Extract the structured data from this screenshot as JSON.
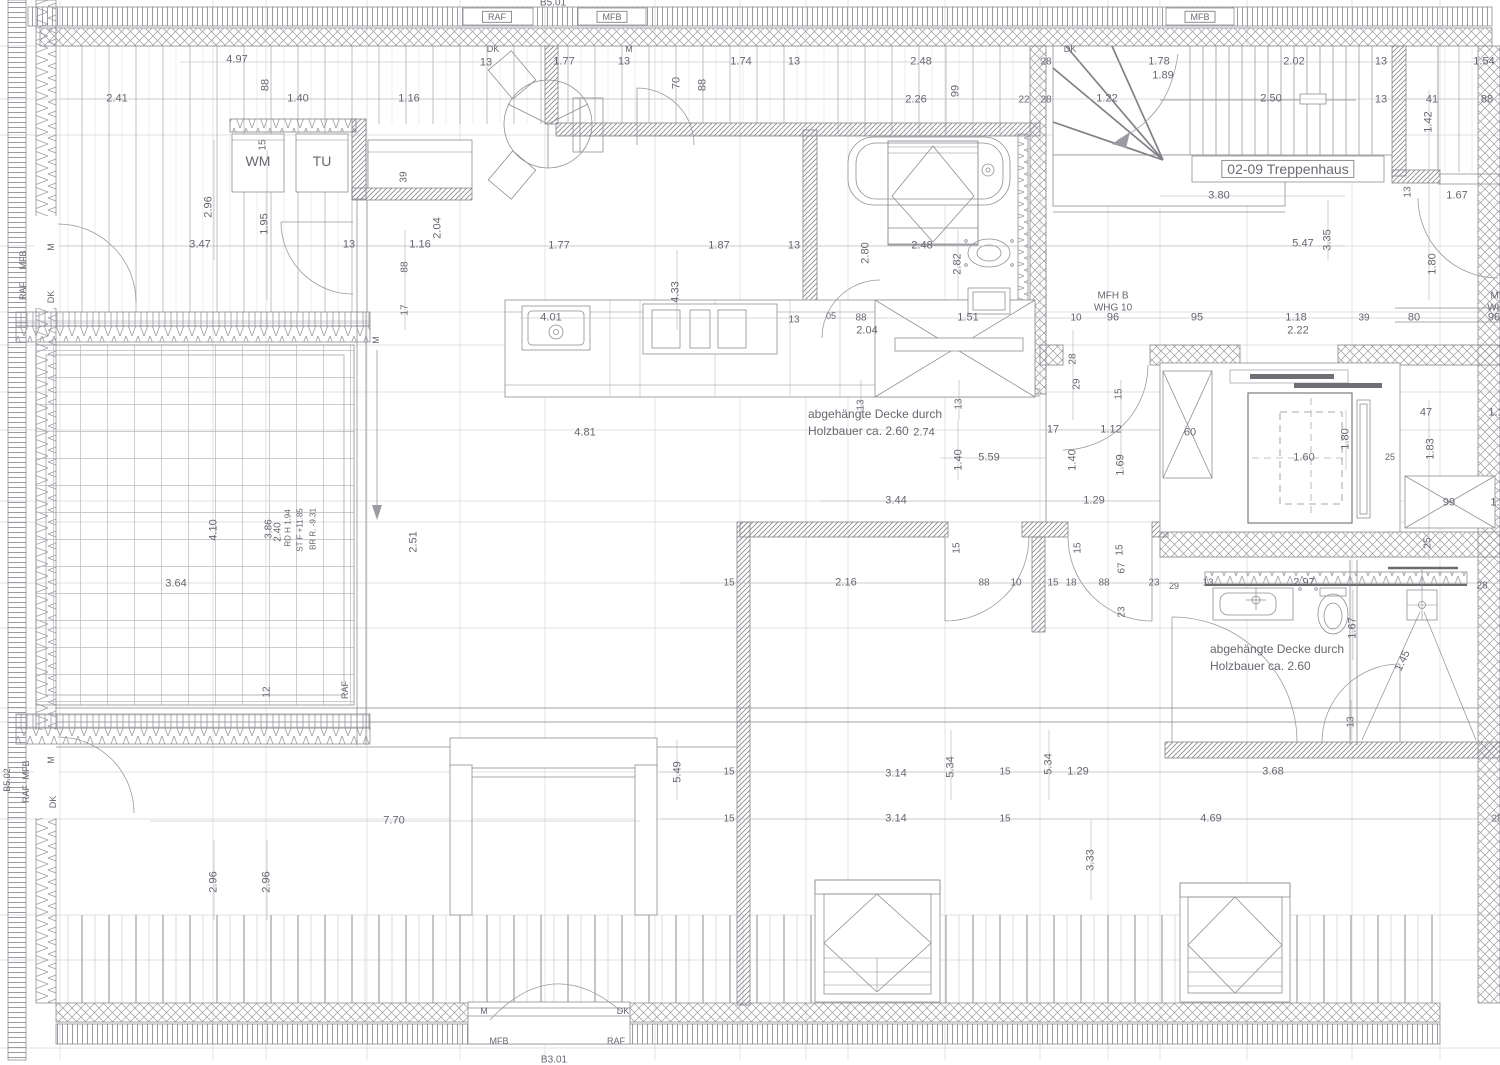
{
  "drawing": {
    "kind": "floor-plan",
    "language": "de",
    "stairwell_label": "02-09 Treppenhaus",
    "apartments": [
      "MFH B WHG 10",
      "MFH B WHG 11"
    ],
    "notes": [
      "abgehängte Decke durch Holzbauer ca. 2.60"
    ],
    "component_tags": [
      "B5.01",
      "B3.01",
      "B5.02"
    ],
    "layer_tags": [
      "RAF",
      "MFB",
      "DK",
      "M"
    ]
  },
  "colors": {
    "line": "#8e8e94",
    "light_line": "#d6d6da",
    "dim_line": "#b4b4ba",
    "text": "#67676f",
    "dark": "#6b6b70",
    "bg": "#ffffff"
  },
  "labels": [
    {
      "t": "RAF",
      "x": 497,
      "y": 17,
      "b": 1,
      "s": 9,
      "n": "layer-tag"
    },
    {
      "t": "MFB",
      "x": 612,
      "y": 17,
      "b": 1,
      "s": 9,
      "n": "layer-tag"
    },
    {
      "t": "MFB",
      "x": 1200,
      "y": 17,
      "b": 1,
      "s": 9,
      "n": "layer-tag"
    },
    {
      "t": "B5.01",
      "x": 553,
      "y": 3,
      "s": 10,
      "n": "component-tag"
    },
    {
      "t": "4.97",
      "x": 237,
      "y": 60
    },
    {
      "t": "DK",
      "x": 493,
      "y": 49,
      "s": 9,
      "n": "layer-tag"
    },
    {
      "t": "13",
      "x": 486,
      "y": 63
    },
    {
      "t": "1.77",
      "x": 564,
      "y": 62
    },
    {
      "t": "13",
      "x": 624,
      "y": 62
    },
    {
      "t": "M",
      "x": 629,
      "y": 49,
      "s": 9,
      "n": "layer-tag"
    },
    {
      "t": "1.74",
      "x": 741,
      "y": 62
    },
    {
      "t": "13",
      "x": 794,
      "y": 62
    },
    {
      "t": "2.48",
      "x": 921,
      "y": 62
    },
    {
      "t": "DK",
      "x": 1070,
      "y": 49,
      "s": 9,
      "n": "layer-tag"
    },
    {
      "t": "28",
      "x": 1046,
      "y": 62,
      "s": 10
    },
    {
      "t": "1.78",
      "x": 1159,
      "y": 62
    },
    {
      "t": "1.89",
      "x": 1163,
      "y": 76
    },
    {
      "t": "2.02",
      "x": 1294,
      "y": 62
    },
    {
      "t": "13",
      "x": 1381,
      "y": 62
    },
    {
      "t": "1.54",
      "x": 1484,
      "y": 62
    },
    {
      "t": "70",
      "x": 677,
      "y": 83,
      "v": 1
    },
    {
      "t": "88",
      "x": 703,
      "y": 85,
      "v": 1
    },
    {
      "t": "88",
      "x": 266,
      "y": 85,
      "v": 1
    },
    {
      "t": "99",
      "x": 956,
      "y": 91,
      "v": 1
    },
    {
      "t": "2.41",
      "x": 117,
      "y": 99
    },
    {
      "t": "1.40",
      "x": 298,
      "y": 99
    },
    {
      "t": "1.16",
      "x": 409,
      "y": 99
    },
    {
      "t": "2.26",
      "x": 916,
      "y": 100
    },
    {
      "t": "22",
      "x": 1024,
      "y": 100,
      "s": 10
    },
    {
      "t": "28",
      "x": 1046,
      "y": 100,
      "s": 10
    },
    {
      "t": "1.22",
      "x": 1107,
      "y": 99
    },
    {
      "t": "2.50",
      "x": 1271,
      "y": 99
    },
    {
      "t": "13",
      "x": 1381,
      "y": 100
    },
    {
      "t": "41",
      "x": 1432,
      "y": 100
    },
    {
      "t": "88",
      "x": 1487,
      "y": 100
    },
    {
      "t": "1.42",
      "x": 1429,
      "y": 122,
      "v": 1
    },
    {
      "t": "WM",
      "x": 258,
      "y": 161,
      "s": 14,
      "n": "washing-machine-label"
    },
    {
      "t": "TU",
      "x": 322,
      "y": 161,
      "s": 14,
      "n": "dryer-label"
    },
    {
      "t": "15",
      "x": 263,
      "y": 145,
      "v": 1,
      "s": 10
    },
    {
      "t": "39",
      "x": 404,
      "y": 177,
      "v": 1,
      "s": 10
    },
    {
      "t": "2.96",
      "x": 209,
      "y": 207,
      "v": 1
    },
    {
      "t": "1.95",
      "x": 265,
      "y": 224,
      "v": 1
    },
    {
      "t": "2.04",
      "x": 438,
      "y": 228,
      "v": 1
    },
    {
      "t": "3.80",
      "x": 1219,
      "y": 196
    },
    {
      "t": "02-09 Treppenhaus",
      "x": 1288,
      "y": 169,
      "s": 14,
      "b": 1,
      "n": "stairwell-label"
    },
    {
      "t": "13",
      "x": 1408,
      "y": 192,
      "v": 1,
      "s": 10
    },
    {
      "t": "1.67",
      "x": 1457,
      "y": 196
    },
    {
      "t": "3.47",
      "x": 200,
      "y": 245
    },
    {
      "t": "13",
      "x": 349,
      "y": 245
    },
    {
      "t": "1.16",
      "x": 420,
      "y": 245
    },
    {
      "t": "1.77",
      "x": 559,
      "y": 246
    },
    {
      "t": "1.87",
      "x": 719,
      "y": 246
    },
    {
      "t": "13",
      "x": 794,
      "y": 246
    },
    {
      "t": "2.48",
      "x": 922,
      "y": 246
    },
    {
      "t": "5.47",
      "x": 1303,
      "y": 244
    },
    {
      "t": "3.35",
      "x": 1328,
      "y": 240,
      "v": 1
    },
    {
      "t": "2.80",
      "x": 866,
      "y": 253,
      "v": 1
    },
    {
      "t": "2.82",
      "x": 958,
      "y": 264,
      "v": 1
    },
    {
      "t": "1.80",
      "x": 1433,
      "y": 264,
      "v": 1
    },
    {
      "t": "88",
      "x": 405,
      "y": 267,
      "v": 1,
      "s": 10
    },
    {
      "t": "17",
      "x": 405,
      "y": 310,
      "v": 1,
      "s": 10
    },
    {
      "t": "4.01",
      "x": 551,
      "y": 318
    },
    {
      "t": "13",
      "x": 794,
      "y": 320,
      "s": 10
    },
    {
      "t": "05",
      "x": 831,
      "y": 316,
      "s": 9
    },
    {
      "t": "88",
      "x": 861,
      "y": 318,
      "s": 10
    },
    {
      "t": "2.04",
      "x": 867,
      "y": 331
    },
    {
      "t": "1.51",
      "x": 968,
      "y": 318
    },
    {
      "t": "10",
      "x": 1076,
      "y": 318,
      "s": 10
    },
    {
      "t": "96",
      "x": 1113,
      "y": 318
    },
    {
      "t": "95",
      "x": 1197,
      "y": 318
    },
    {
      "t": "1.18",
      "x": 1296,
      "y": 318
    },
    {
      "t": "2.22",
      "x": 1298,
      "y": 331
    },
    {
      "t": "39",
      "x": 1364,
      "y": 318,
      "s": 10
    },
    {
      "t": "80",
      "x": 1414,
      "y": 318
    },
    {
      "t": "96",
      "x": 1494,
      "y": 318
    },
    {
      "t": "MFH B",
      "x": 1113,
      "y": 296,
      "s": 10,
      "n": "apartment-label"
    },
    {
      "t": "WHG 10",
      "x": 1113,
      "y": 308,
      "s": 10,
      "n": "apartment-label"
    },
    {
      "t": "MFH B",
      "x": 1506,
      "y": 296,
      "s": 10,
      "n": "apartment-label"
    },
    {
      "t": "WHG 11",
      "x": 1506,
      "y": 308,
      "s": 10,
      "n": "apartment-label"
    },
    {
      "t": "28",
      "x": 1073,
      "y": 359,
      "v": 1,
      "s": 10
    },
    {
      "t": "29",
      "x": 1077,
      "y": 384,
      "v": 1,
      "s": 10
    },
    {
      "t": "4.33",
      "x": 676,
      "y": 292,
      "v": 1
    },
    {
      "t": "4.81",
      "x": 585,
      "y": 433
    },
    {
      "t": "13",
      "x": 861,
      "y": 405,
      "v": 1,
      "s": 10
    },
    {
      "t": "13",
      "x": 959,
      "y": 404,
      "v": 1,
      "s": 10
    },
    {
      "t": "abgehängte Decke durch",
      "x": 808,
      "y": 415,
      "a": "l",
      "s": 12,
      "n": "ceiling-note"
    },
    {
      "t": "Holzbauer ca. 2.60",
      "x": 808,
      "y": 432,
      "a": "l",
      "s": 12,
      "n": "ceiling-note"
    },
    {
      "t": "2.74",
      "x": 924,
      "y": 433
    },
    {
      "t": "17",
      "x": 1053,
      "y": 430
    },
    {
      "t": "1.12",
      "x": 1111,
      "y": 430
    },
    {
      "t": "1.40",
      "x": 959,
      "y": 460,
      "v": 1
    },
    {
      "t": "5.59",
      "x": 989,
      "y": 458
    },
    {
      "t": "1.40",
      "x": 1073,
      "y": 460,
      "v": 1
    },
    {
      "t": "1.69",
      "x": 1121,
      "y": 465,
      "v": 1
    },
    {
      "t": "3.44",
      "x": 896,
      "y": 501
    },
    {
      "t": "1.29",
      "x": 1094,
      "y": 501
    },
    {
      "t": "2.51",
      "x": 414,
      "y": 542,
      "v": 1
    },
    {
      "t": "M",
      "x": 376,
      "y": 340,
      "v": 1,
      "s": 9,
      "n": "layer-tag"
    },
    {
      "t": "60",
      "x": 1190,
      "y": 433
    },
    {
      "t": "1.60",
      "x": 1304,
      "y": 458
    },
    {
      "t": "1.80",
      "x": 1346,
      "y": 439,
      "v": 1
    },
    {
      "t": "25",
      "x": 1390,
      "y": 457,
      "s": 9
    },
    {
      "t": "47",
      "x": 1426,
      "y": 413
    },
    {
      "t": "1.1",
      "x": 1496,
      "y": 413
    },
    {
      "t": "1.83",
      "x": 1431,
      "y": 449,
      "v": 1
    },
    {
      "t": "99",
      "x": 1449,
      "y": 503
    },
    {
      "t": "1.",
      "x": 1495,
      "y": 503
    },
    {
      "t": "25",
      "x": 1428,
      "y": 543,
      "v": 1,
      "s": 10
    },
    {
      "t": "3.64",
      "x": 176,
      "y": 584
    },
    {
      "t": "4.10",
      "x": 214,
      "y": 530,
      "v": 1
    },
    {
      "t": "3.86",
      "x": 269,
      "y": 529,
      "v": 1,
      "s": 10
    },
    {
      "t": "2.40",
      "x": 278,
      "y": 532,
      "v": 1,
      "s": 10
    },
    {
      "t": "RD H 1.94",
      "x": 288,
      "y": 528,
      "v": 1,
      "s": 8
    },
    {
      "t": "ST F +11.85",
      "x": 300,
      "y": 530,
      "v": 1,
      "s": 8
    },
    {
      "t": "BR R. -9.31",
      "x": 313,
      "y": 529,
      "v": 1,
      "s": 8
    },
    {
      "t": "12",
      "x": 267,
      "y": 692,
      "v": 1,
      "s": 10
    },
    {
      "t": "RAF",
      "x": 345,
      "y": 690,
      "v": 1,
      "s": 9,
      "n": "layer-tag"
    },
    {
      "t": "15",
      "x": 729,
      "y": 583,
      "s": 10
    },
    {
      "t": "2.16",
      "x": 846,
      "y": 583
    },
    {
      "t": "88",
      "x": 984,
      "y": 583,
      "s": 10
    },
    {
      "t": "10",
      "x": 1016,
      "y": 583,
      "s": 10
    },
    {
      "t": "15",
      "x": 1053,
      "y": 583,
      "s": 10
    },
    {
      "t": "18",
      "x": 1071,
      "y": 583,
      "s": 10
    },
    {
      "t": "88",
      "x": 1104,
      "y": 583,
      "s": 10
    },
    {
      "t": "23",
      "x": 1154,
      "y": 583,
      "s": 10
    },
    {
      "t": "29",
      "x": 1174,
      "y": 586,
      "s": 9
    },
    {
      "t": "13",
      "x": 1208,
      "y": 583,
      "s": 10
    },
    {
      "t": "2.97",
      "x": 1304,
      "y": 583
    },
    {
      "t": "28",
      "x": 1482,
      "y": 586,
      "s": 10
    },
    {
      "t": "15",
      "x": 957,
      "y": 548,
      "v": 1,
      "s": 10
    },
    {
      "t": "15",
      "x": 1078,
      "y": 548,
      "v": 1,
      "s": 10
    },
    {
      "t": "15",
      "x": 1120,
      "y": 550,
      "v": 1,
      "s": 10
    },
    {
      "t": "15",
      "x": 1119,
      "y": 394,
      "v": 1,
      "s": 10
    },
    {
      "t": "67",
      "x": 1122,
      "y": 568,
      "v": 1,
      "s": 10
    },
    {
      "t": "23",
      "x": 1122,
      "y": 612,
      "v": 1,
      "s": 10
    },
    {
      "t": "1.67",
      "x": 1353,
      "y": 628,
      "v": 1
    },
    {
      "t": "1.45",
      "x": 1403,
      "y": 661,
      "d": -65
    },
    {
      "t": "13",
      "x": 1351,
      "y": 722,
      "v": 1,
      "s": 10
    },
    {
      "t": "abgehängte Decke durch",
      "x": 1210,
      "y": 650,
      "a": "l",
      "s": 12,
      "n": "ceiling-note"
    },
    {
      "t": "Holzbauer ca. 2.60",
      "x": 1210,
      "y": 667,
      "a": "l",
      "s": 12,
      "n": "ceiling-note"
    },
    {
      "t": "5.49",
      "x": 678,
      "y": 772,
      "v": 1
    },
    {
      "t": "15",
      "x": 729,
      "y": 772,
      "s": 10
    },
    {
      "t": "3.14",
      "x": 896,
      "y": 774
    },
    {
      "t": "5.34",
      "x": 951,
      "y": 767,
      "v": 1
    },
    {
      "t": "5.34",
      "x": 1049,
      "y": 764,
      "v": 1
    },
    {
      "t": "15",
      "x": 1005,
      "y": 772,
      "s": 10
    },
    {
      "t": "1.29",
      "x": 1078,
      "y": 772
    },
    {
      "t": "3.68",
      "x": 1273,
      "y": 772
    },
    {
      "t": "15",
      "x": 729,
      "y": 819,
      "s": 10
    },
    {
      "t": "3.14",
      "x": 896,
      "y": 819
    },
    {
      "t": "15",
      "x": 1005,
      "y": 819,
      "s": 10
    },
    {
      "t": "4.69",
      "x": 1211,
      "y": 819
    },
    {
      "t": "28",
      "x": 1497,
      "y": 819,
      "s": 10
    },
    {
      "t": "3.33",
      "x": 1091,
      "y": 860,
      "v": 1
    },
    {
      "t": "7.70",
      "x": 394,
      "y": 821
    },
    {
      "t": "2.96",
      "x": 214,
      "y": 882,
      "v": 1
    },
    {
      "t": "2.96",
      "x": 267,
      "y": 882,
      "v": 1
    },
    {
      "t": "M",
      "x": 484,
      "y": 1011,
      "s": 9,
      "n": "layer-tag"
    },
    {
      "t": "DK",
      "x": 623,
      "y": 1011,
      "s": 9,
      "n": "layer-tag"
    },
    {
      "t": "MFB",
      "x": 499,
      "y": 1041,
      "s": 9,
      "n": "layer-tag"
    },
    {
      "t": "RAF",
      "x": 616,
      "y": 1041,
      "s": 9,
      "n": "layer-tag"
    },
    {
      "t": "B3.01",
      "x": 554,
      "y": 1060,
      "s": 10,
      "n": "component-tag"
    },
    {
      "t": "M",
      "x": 51,
      "y": 247,
      "v": 1,
      "s": 9,
      "n": "layer-tag"
    },
    {
      "t": "DK",
      "x": 51,
      "y": 297,
      "v": 1,
      "s": 9,
      "n": "layer-tag"
    },
    {
      "t": "MFB",
      "x": 23,
      "y": 260,
      "v": 1,
      "s": 9,
      "n": "layer-tag"
    },
    {
      "t": "RAF",
      "x": 23,
      "y": 291,
      "v": 1,
      "s": 9,
      "n": "layer-tag"
    },
    {
      "t": "M",
      "x": 51,
      "y": 760,
      "v": 1,
      "s": 9,
      "n": "layer-tag"
    },
    {
      "t": "DK",
      "x": 53,
      "y": 802,
      "v": 1,
      "s": 9,
      "n": "layer-tag"
    },
    {
      "t": "MFB",
      "x": 26,
      "y": 770,
      "v": 1,
      "s": 9,
      "n": "layer-tag"
    },
    {
      "t": "RAF",
      "x": 26,
      "y": 794,
      "v": 1,
      "s": 9,
      "n": "layer-tag"
    },
    {
      "t": "B5.02",
      "x": 7,
      "y": 780,
      "v": 1,
      "s": 9,
      "n": "component-tag"
    }
  ]
}
